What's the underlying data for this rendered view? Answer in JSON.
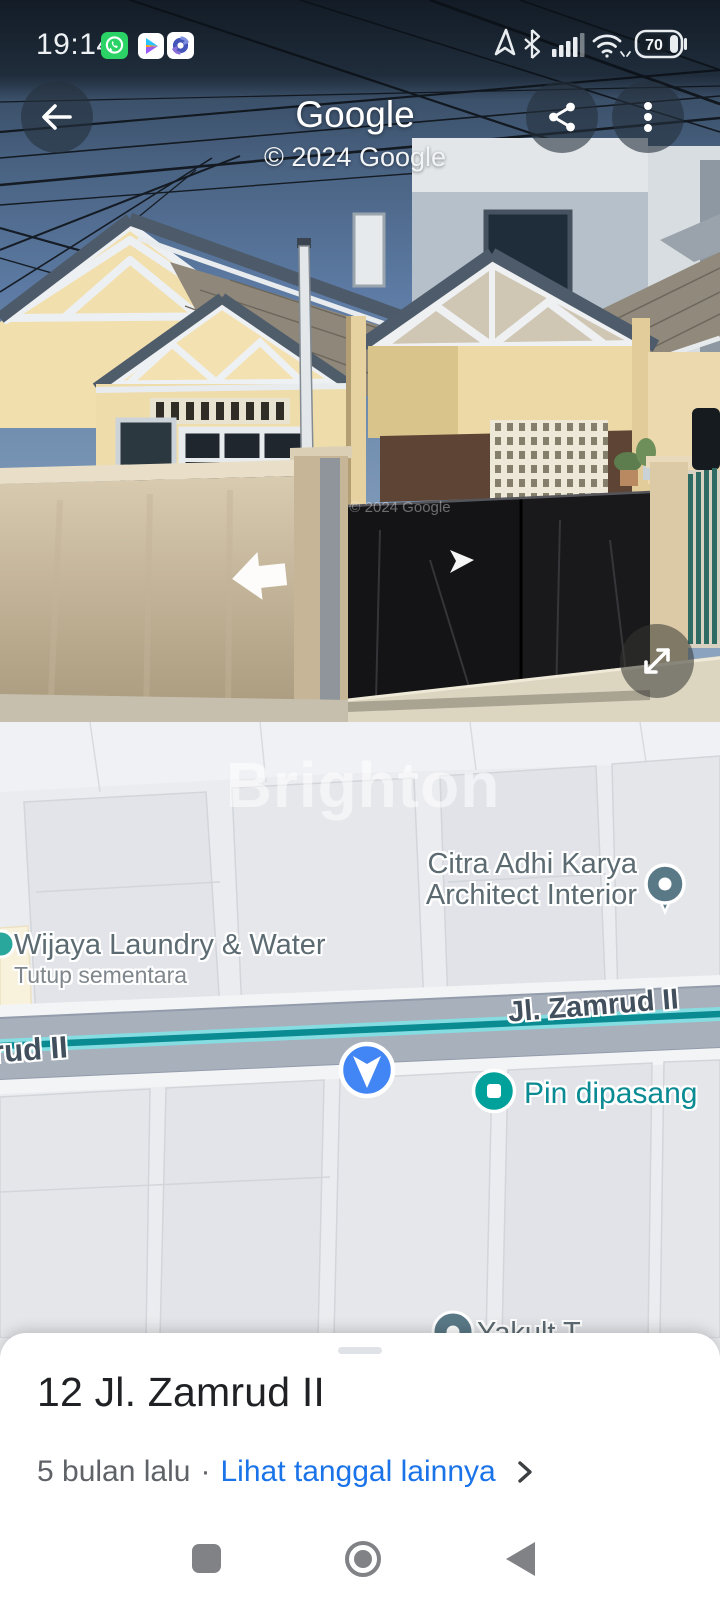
{
  "status_bar": {
    "time": "19:14",
    "battery_level": "70"
  },
  "header": {
    "title": "Google",
    "copyright": "© 2024 Google"
  },
  "street_view": {
    "watermark": "© 2024 Google"
  },
  "map": {
    "watermark": "Brighton",
    "pois": {
      "citra": {
        "line1": "Citra Adhi Karya",
        "line2": "Architect Interior"
      },
      "wijaya": {
        "name": "Wijaya Laundry & Water",
        "status": "Tutup sementara"
      },
      "partial_bottom": {
        "label": "Yakult T"
      }
    },
    "roads": {
      "main_label": "Jl. Zamrud II",
      "partial_label": "rud II"
    },
    "pin": {
      "label": "Pin dipasang"
    }
  },
  "bottom_sheet": {
    "title": "12 Jl. Zamrud II",
    "time_ago": "5 bulan lalu",
    "separator": "·",
    "link_label": "Lihat tanggal lainnya"
  },
  "colors": {
    "accent_blue": "#4285f4",
    "link_blue": "#1a73e8",
    "pin_teal": "#00a09b",
    "poi_slate": "#5a7987",
    "road_teal": "#0a8a91"
  }
}
